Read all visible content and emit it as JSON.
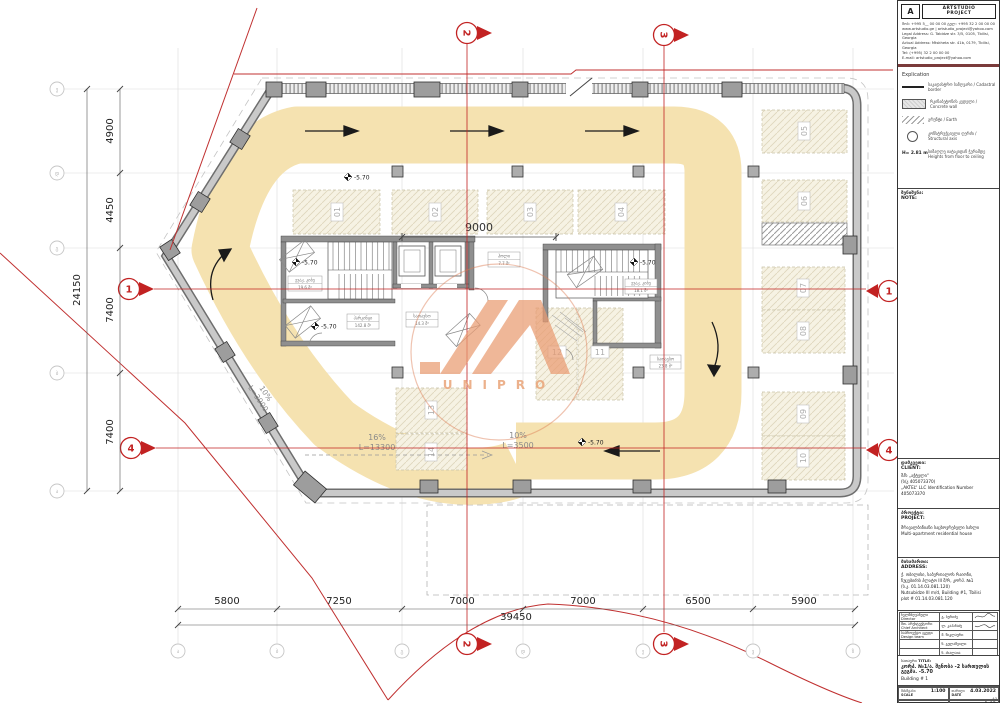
{
  "title_block": {
    "logo": {
      "mark": "A",
      "name_line1": "ARTSTUDIO",
      "name_line2": "PROJECT"
    },
    "contact_lines": [
      "მობ: +995 5__ 00 00 00   ტელ: +995 32 2 00 00 00",
      "www.artstudio.ge  |  artstudio_project@yahoo.com",
      "Legal Address: G. Tabidze str. 3/5, 0105, Tbilisi, Georgia",
      "Actual Address: Mtskheta str. 41b, 0179, Tbilisi, Georgia",
      "Tel: (+995) 32 2 00 00 00",
      "E-mail: artstudio_project@yahoo.com"
    ],
    "explication": {
      "heading": "Explication",
      "items": [
        {
          "label_ka": "საკადასტრო საზღვარი",
          "label_en": "Cadastral border"
        },
        {
          "label_ka": "რკინაბეტონის კედელი",
          "label_en": "Concrete wall"
        },
        {
          "label_ka": "გრუნტი",
          "label_en": "Earth"
        },
        {
          "label_ka": "კონსტრუქციული ღერძი",
          "label_en": "Structural axis"
        },
        {
          "height_value": "H= 2.81 m",
          "label_ka": "სიმაღლე იატაკიდან ჭერამდე",
          "label_en": "Heights from floor to ceiling"
        }
      ]
    },
    "note": {
      "label_ka": "შენიშვნა:",
      "label_en": "NOTE:"
    },
    "client": {
      "label_ka": "დამკვეთი:",
      "label_en": "CLIENT:",
      "lines": [
        "შპს „აქტელი“",
        "(ს/კ 405073370)",
        "„AKTEL“ LLC Identification Number 405073370"
      ]
    },
    "project": {
      "label_ka": "პროექტი:",
      "label_en": "PROJECT:",
      "lines": [
        "მრავალბინიანი საცხოვრებელი სახლი",
        "Multi-apartment residential house"
      ]
    },
    "address": {
      "label_ka": "მისამართი:",
      "label_en": "ADDRESS:",
      "lines": [
        "ქ. თბილისი, საბურთალოს რაიონი,",
        "ნუცუბიძის პლატო III მ/რ, კორპ. №1",
        "(ს.კ. 01.14.03.081.120)",
        "Nutsubidze III m/d, Building #1, Tbilisi",
        "plot # 01.14.03.081.120"
      ]
    },
    "team": {
      "rows": [
        {
          "role_ka": "ხელმძღვანელი",
          "role_en": "Director",
          "name": "გ. ბერიძე"
        },
        {
          "role_ka": "მთ. არქიტექტორი",
          "role_en": "Chief Architect",
          "name": "ლ. კაპანაძე"
        },
        {
          "role_ka": "საპროექტო ჯგუფი",
          "role_en": "Design team",
          "name": "მ. წიკლაური"
        },
        {
          "role_ka": "",
          "role_en": "",
          "name": "ნ. გელაშვილი"
        },
        {
          "role_ka": "",
          "role_en": "",
          "name": "ნ. ახალაია"
        }
      ]
    },
    "title": {
      "label_ka": "სათაური",
      "label_en": "TITLE:",
      "text": "კორპ. №1/ა. შენობა -2 სართულის გეგმა. -5.70",
      "building": "Building # 1"
    },
    "meta": {
      "scale_label_ka": "მასშტაბი",
      "scale_label_en": "SCALE",
      "scale": "1:100",
      "date_label_ka": "თარიღი",
      "date_label_en": "DATE",
      "date": "4.03.2022",
      "stage_label_ka": "ეტაპი",
      "stage_label_en": "STAGE",
      "stage": "",
      "sheet_label_ka": "ფურცელი",
      "sheet_label_en": "SHEET",
      "sheet": "1-02",
      "paper": "A3"
    }
  },
  "plan": {
    "dimensions": {
      "bottom": [
        "5800",
        "7250",
        "7000",
        "7000",
        "6500",
        "5900"
      ],
      "bottom_total": "39450",
      "left": [
        "4900",
        "4450",
        "7400",
        "7400"
      ],
      "left_total": "24150",
      "interior": "9000"
    },
    "axes": {
      "red": [
        "1",
        "2",
        "3",
        "4"
      ],
      "gray_left": [
        "ე",
        "დ",
        "გ",
        "ბ",
        "ა"
      ],
      "gray_bottom": [
        "ა",
        "ბ",
        "გ",
        "დ",
        "ე",
        "ვ",
        "ზ"
      ]
    },
    "parking_labels": [
      "01",
      "02",
      "03",
      "04",
      "05",
      "06",
      "07",
      "08",
      "09",
      "10",
      "11",
      "12",
      "13",
      "14"
    ],
    "level_value": "-5.70",
    "ramps": [
      {
        "slope": "10%",
        "length": "L=3900"
      },
      {
        "slope": "16%",
        "length": "L=13300"
      },
      {
        "slope": "10%",
        "length": "L=3500"
      }
    ],
    "rooms": [
      {
        "name": "ევაკ. კიბე",
        "area": "19.6 მ²"
      },
      {
        "name": "პარკინგი",
        "area": "142.8 მ²"
      },
      {
        "name": "სათავსო",
        "area": "14.3 მ²"
      },
      {
        "name": "ევაკ. კიბე",
        "area": "18.1 მ²"
      },
      {
        "name": "ჰოლი",
        "area": "7.7 მ²"
      },
      {
        "name": "სათავსო",
        "area": "23.8 მ²"
      }
    ],
    "watermark": {
      "text": "UNIPRO"
    }
  },
  "colors": {
    "driveway": "#F5E2B0",
    "accent_red": "#C03030",
    "wall_gray": "#C9C9C9",
    "watermark_orange": "#E99B71"
  }
}
